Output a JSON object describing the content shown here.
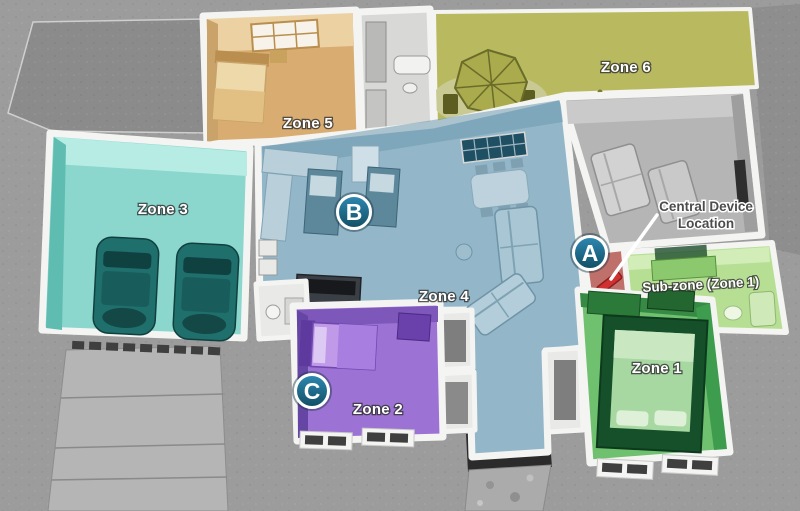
{
  "diagram": {
    "type": "isometric-floorplan",
    "background_color": "#9c9c9c",
    "background_dark_patch_color": "#8b8b8b",
    "driveway_color": "#b5b5b5",
    "wall_color": "#f4f4f2",
    "zones": {
      "zone1": {
        "label": "Zone 1",
        "floor_color": "#6fc06f",
        "contents": "bedroom"
      },
      "zone2": {
        "label": "Zone 2",
        "floor_color": "#9c72d4",
        "contents": "bedroom"
      },
      "zone3": {
        "label": "Zone 3",
        "floor_color": "#8bd6cd",
        "contents": "garage-two-cars"
      },
      "zone4": {
        "label": "Zone 4",
        "floor_color": "#93b7c8",
        "contents": "kitchen-living-dining"
      },
      "zone5": {
        "label": "Zone 5",
        "floor_color": "#d9ad72",
        "contents": "bedroom"
      },
      "zone6": {
        "label": "Zone 6",
        "floor_color": "#b9ba5f",
        "contents": "patio"
      },
      "subzone": {
        "label": "Sub-zone (Zone 1)",
        "floor_color": "#b6df94",
        "contents": "bathroom"
      },
      "family_room": {
        "floor_color": "#b5b5b5",
        "contents": "family-room"
      },
      "device_area": {
        "floor_color": "#c0706a",
        "device_color": "#d03030"
      }
    },
    "markers": {
      "a": {
        "letter": "A"
      },
      "b": {
        "letter": "B"
      },
      "c": {
        "letter": "C"
      }
    },
    "marker_style": {
      "fill_top": "#2e89b3",
      "fill_bottom": "#114e63",
      "ring": "#ffffff"
    },
    "callout": {
      "line1": "Central Device",
      "line2": "Location"
    }
  }
}
